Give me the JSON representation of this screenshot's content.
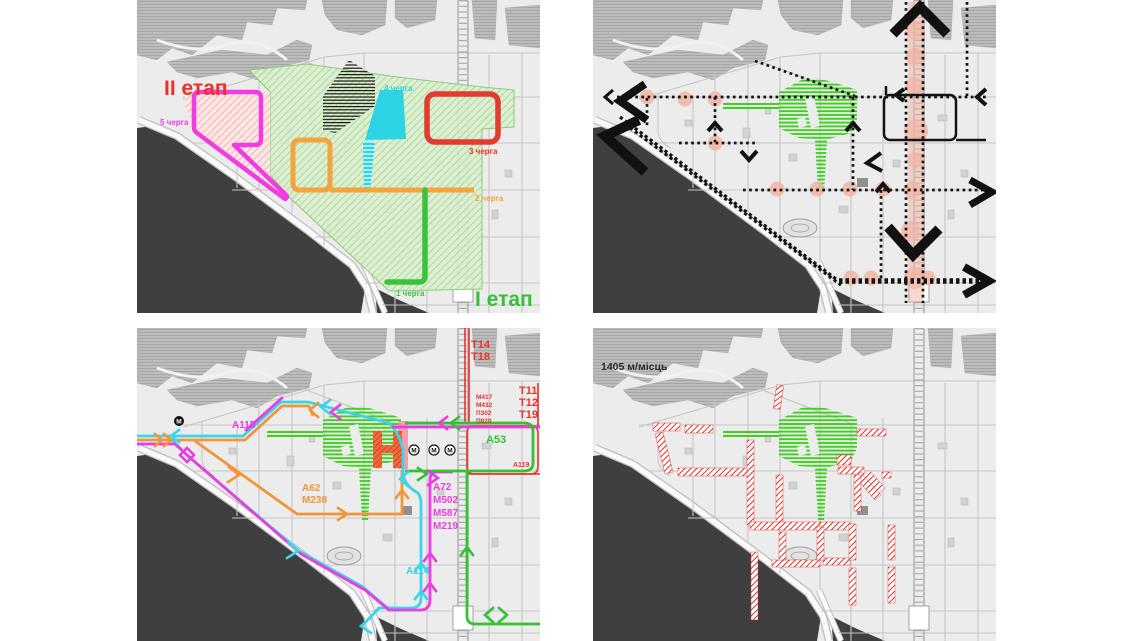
{
  "stage_plan": {
    "stage2": "ІІ етап",
    "stage1": "І етап",
    "queue5": "5 черга",
    "queue4": "4 черга",
    "queue3": "3 черга",
    "queue2": "2 черга",
    "queue1": "1 черга"
  },
  "transit": {
    "tram_top_1": "Т14",
    "tram_top_2": "Т18",
    "tram_right_1": "Т11",
    "tram_right_2": "Т12",
    "tram_right_3": "Т19",
    "bus_red_1": "М417",
    "bus_red_2": "М432",
    "bus_red_3": "П302",
    "bus_red_4": "П820",
    "a115": "А115",
    "a53": "А53",
    "a119": "А119",
    "orange_1": "А62",
    "orange_2": "М238",
    "magenta_1": "А72",
    "magenta_2": "М502",
    "magenta_3": "М587",
    "magenta_4": "М219",
    "a114": "А114",
    "metro": "М"
  },
  "parking": {
    "capacity": "1405 м/місць"
  },
  "colors": {
    "stage2_red": "#e8322a",
    "stage1_green": "#35c135",
    "queue5_magenta": "#f03ce0",
    "queue4_cyan": "#2bd3e3",
    "queue3_red": "#e23b30",
    "queue2_orange": "#f2a53a",
    "queue1_green": "#3cc13c",
    "salmon_node": "#f1b3a2",
    "water_dark": "#3f3f3f",
    "parking_red": "#e0251d",
    "transit_green_hatch": "#3ecf1f"
  }
}
